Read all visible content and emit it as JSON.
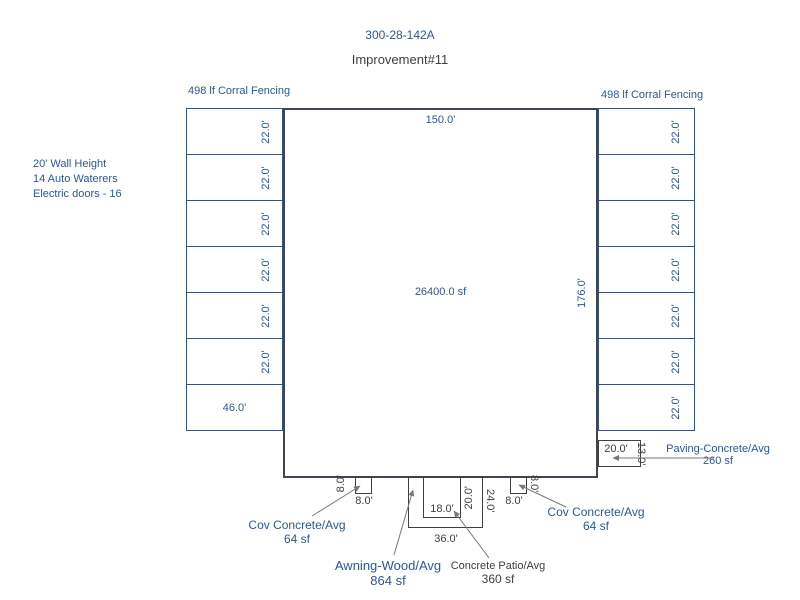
{
  "colors": {
    "accent_blue": "#2B579A",
    "line_blue": "#305586",
    "dark_line": "#3F3F3F",
    "arrow_gray": "#777777"
  },
  "header": {
    "parcel_id": "300-28-142A",
    "improvement": "Improvement#11"
  },
  "annotations": {
    "fencing_left": "498 lf Corral Fencing",
    "fencing_right": "498 lf Corral Fencing",
    "notes_line1": "20' Wall Height",
    "notes_line2": "14 Auto Waterers",
    "notes_line3": "Electric doors - 16"
  },
  "main_building": {
    "width_label": "150.0'",
    "area_label": "26400.0 sf",
    "height_label": "176.0'"
  },
  "left_stalls": {
    "rows": [
      "22.0'",
      "22.0'",
      "22.0'",
      "22.0'",
      "22.0'",
      "22.0'"
    ],
    "bottom_width_label": "46.0'"
  },
  "right_stalls": {
    "rows": [
      "22.0'",
      "22.0'",
      "22.0'",
      "22.0'",
      "22.0'",
      "22.0'",
      "22.0'"
    ]
  },
  "attachments": {
    "cov_concrete_left": {
      "name": "Cov Concrete/Avg",
      "area": "64 sf",
      "width_label": "8.0'",
      "height_label": "8.0'"
    },
    "awning": {
      "name": "Awning-Wood/Avg",
      "area": "864 sf",
      "width_label": "36.0'",
      "height_label": "24.0'"
    },
    "concrete_patio": {
      "name": "Concrete Patio/Avg",
      "area": "360 sf",
      "width_label": "18.0'",
      "height_label": "20.0'"
    },
    "cov_concrete_right": {
      "name": "Cov Concrete/Avg",
      "area": "64 sf",
      "width_label": "8.0'",
      "height_label": "8.0'"
    },
    "paving": {
      "name": "Paving-Concrete/Avg",
      "area": "260 sf",
      "width_label": "20.0'",
      "height_label": "13.0'"
    }
  }
}
